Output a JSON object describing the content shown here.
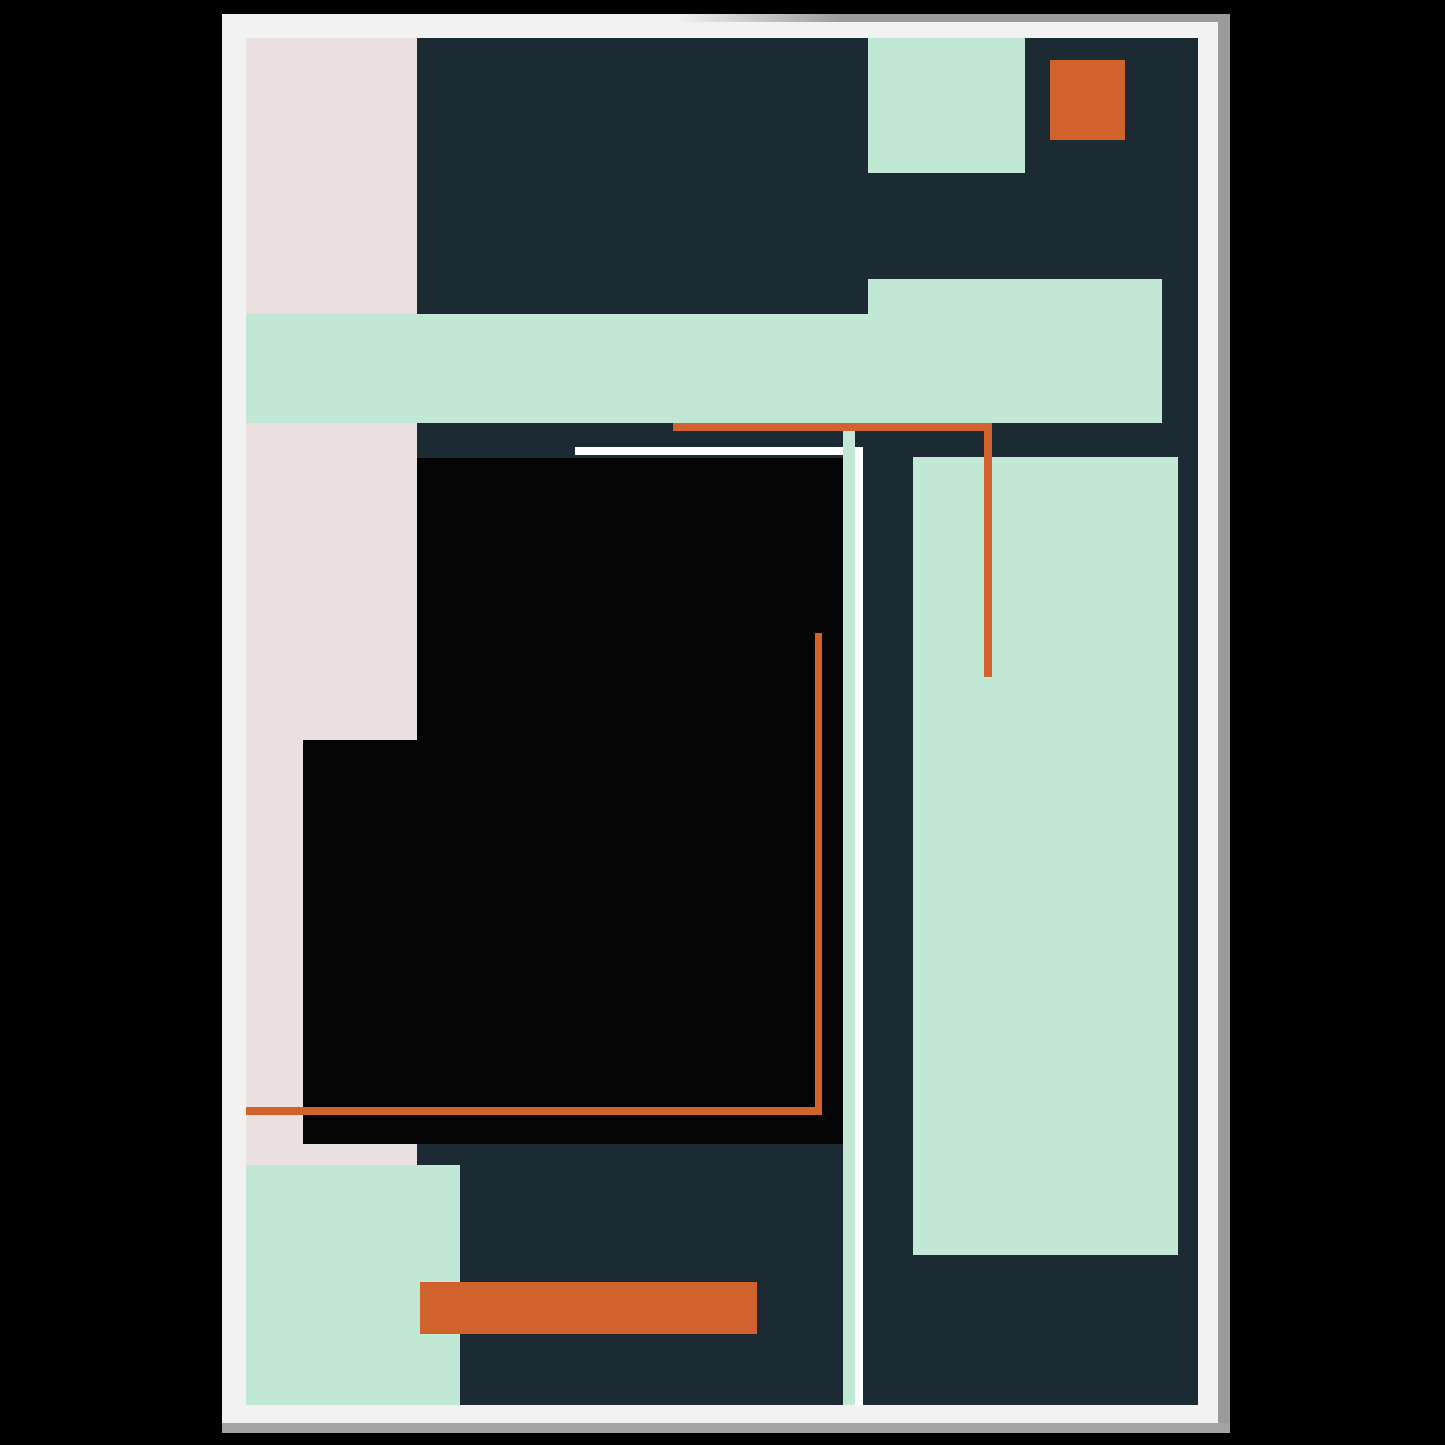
{
  "artwork": {
    "description": "Framed abstract geometric art poster mockup",
    "background_color": "#000000",
    "palette": {
      "navy": "#1c2a33",
      "mint": "#c1e8d4",
      "pink": "#eae0e0",
      "orange": "#d2622b",
      "black": "#040404",
      "white": "#ffffff",
      "frame_white": "#f2f2f2",
      "frame_edge_right": "#9a9a9a",
      "frame_edge_bottom": "#a3a3a3"
    },
    "frame": {
      "x": 222,
      "y": 14,
      "width": 1008,
      "height": 1419,
      "edge_right_width": 12,
      "edge_bottom_height": 10
    },
    "poster": {
      "x": 24,
      "y": 24,
      "width": 952,
      "height": 1367
    },
    "shapes": [
      {
        "name": "pink-left-column",
        "x": 0,
        "y": 0,
        "w": 171,
        "h": 1127,
        "color": "pink"
      },
      {
        "name": "mint-horizontal-band",
        "x": 0,
        "y": 276,
        "w": 916,
        "h": 109,
        "color": "mint"
      },
      {
        "name": "mint-band-right-extension",
        "x": 622,
        "y": 241,
        "w": 294,
        "h": 144,
        "color": "mint"
      },
      {
        "name": "mint-top-right-rect",
        "x": 622,
        "y": 0,
        "w": 157,
        "h": 135,
        "color": "mint"
      },
      {
        "name": "orange-top-square",
        "x": 804,
        "y": 22,
        "w": 75,
        "h": 80,
        "color": "orange"
      },
      {
        "name": "black-square-main",
        "x": 171,
        "y": 420,
        "w": 426,
        "h": 686,
        "color": "black"
      },
      {
        "name": "black-square-left-step",
        "x": 57,
        "y": 702,
        "w": 114,
        "h": 404,
        "color": "black"
      },
      {
        "name": "mint-bottom-left-square",
        "x": 0,
        "y": 1127,
        "w": 214,
        "h": 240,
        "color": "mint"
      },
      {
        "name": "mint-tall-right-rect",
        "x": 667,
        "y": 419,
        "w": 265,
        "h": 798,
        "color": "mint"
      },
      {
        "name": "mint-vertical-line",
        "x": 597,
        "y": 386,
        "w": 12,
        "h": 981,
        "color": "mint"
      },
      {
        "name": "white-horizontal-line",
        "x": 329,
        "y": 409,
        "w": 268,
        "h": 8,
        "color": "white"
      },
      {
        "name": "white-vertical-line",
        "x": 609,
        "y": 409,
        "w": 8,
        "h": 958,
        "color": "white"
      },
      {
        "name": "orange-horizontal-line-top",
        "x": 427,
        "y": 385,
        "w": 319,
        "h": 8,
        "color": "orange"
      },
      {
        "name": "orange-vertical-line-right",
        "x": 738,
        "y": 385,
        "w": 8,
        "h": 254,
        "color": "orange"
      },
      {
        "name": "orange-vertical-line-inner",
        "x": 569,
        "y": 595,
        "w": 7,
        "h": 482,
        "color": "orange"
      },
      {
        "name": "orange-horizontal-line-bottom",
        "x": 0,
        "y": 1069,
        "w": 576,
        "h": 8,
        "color": "orange"
      },
      {
        "name": "orange-bottom-bar",
        "x": 174,
        "y": 1244,
        "w": 337,
        "h": 52,
        "color": "orange"
      }
    ]
  }
}
